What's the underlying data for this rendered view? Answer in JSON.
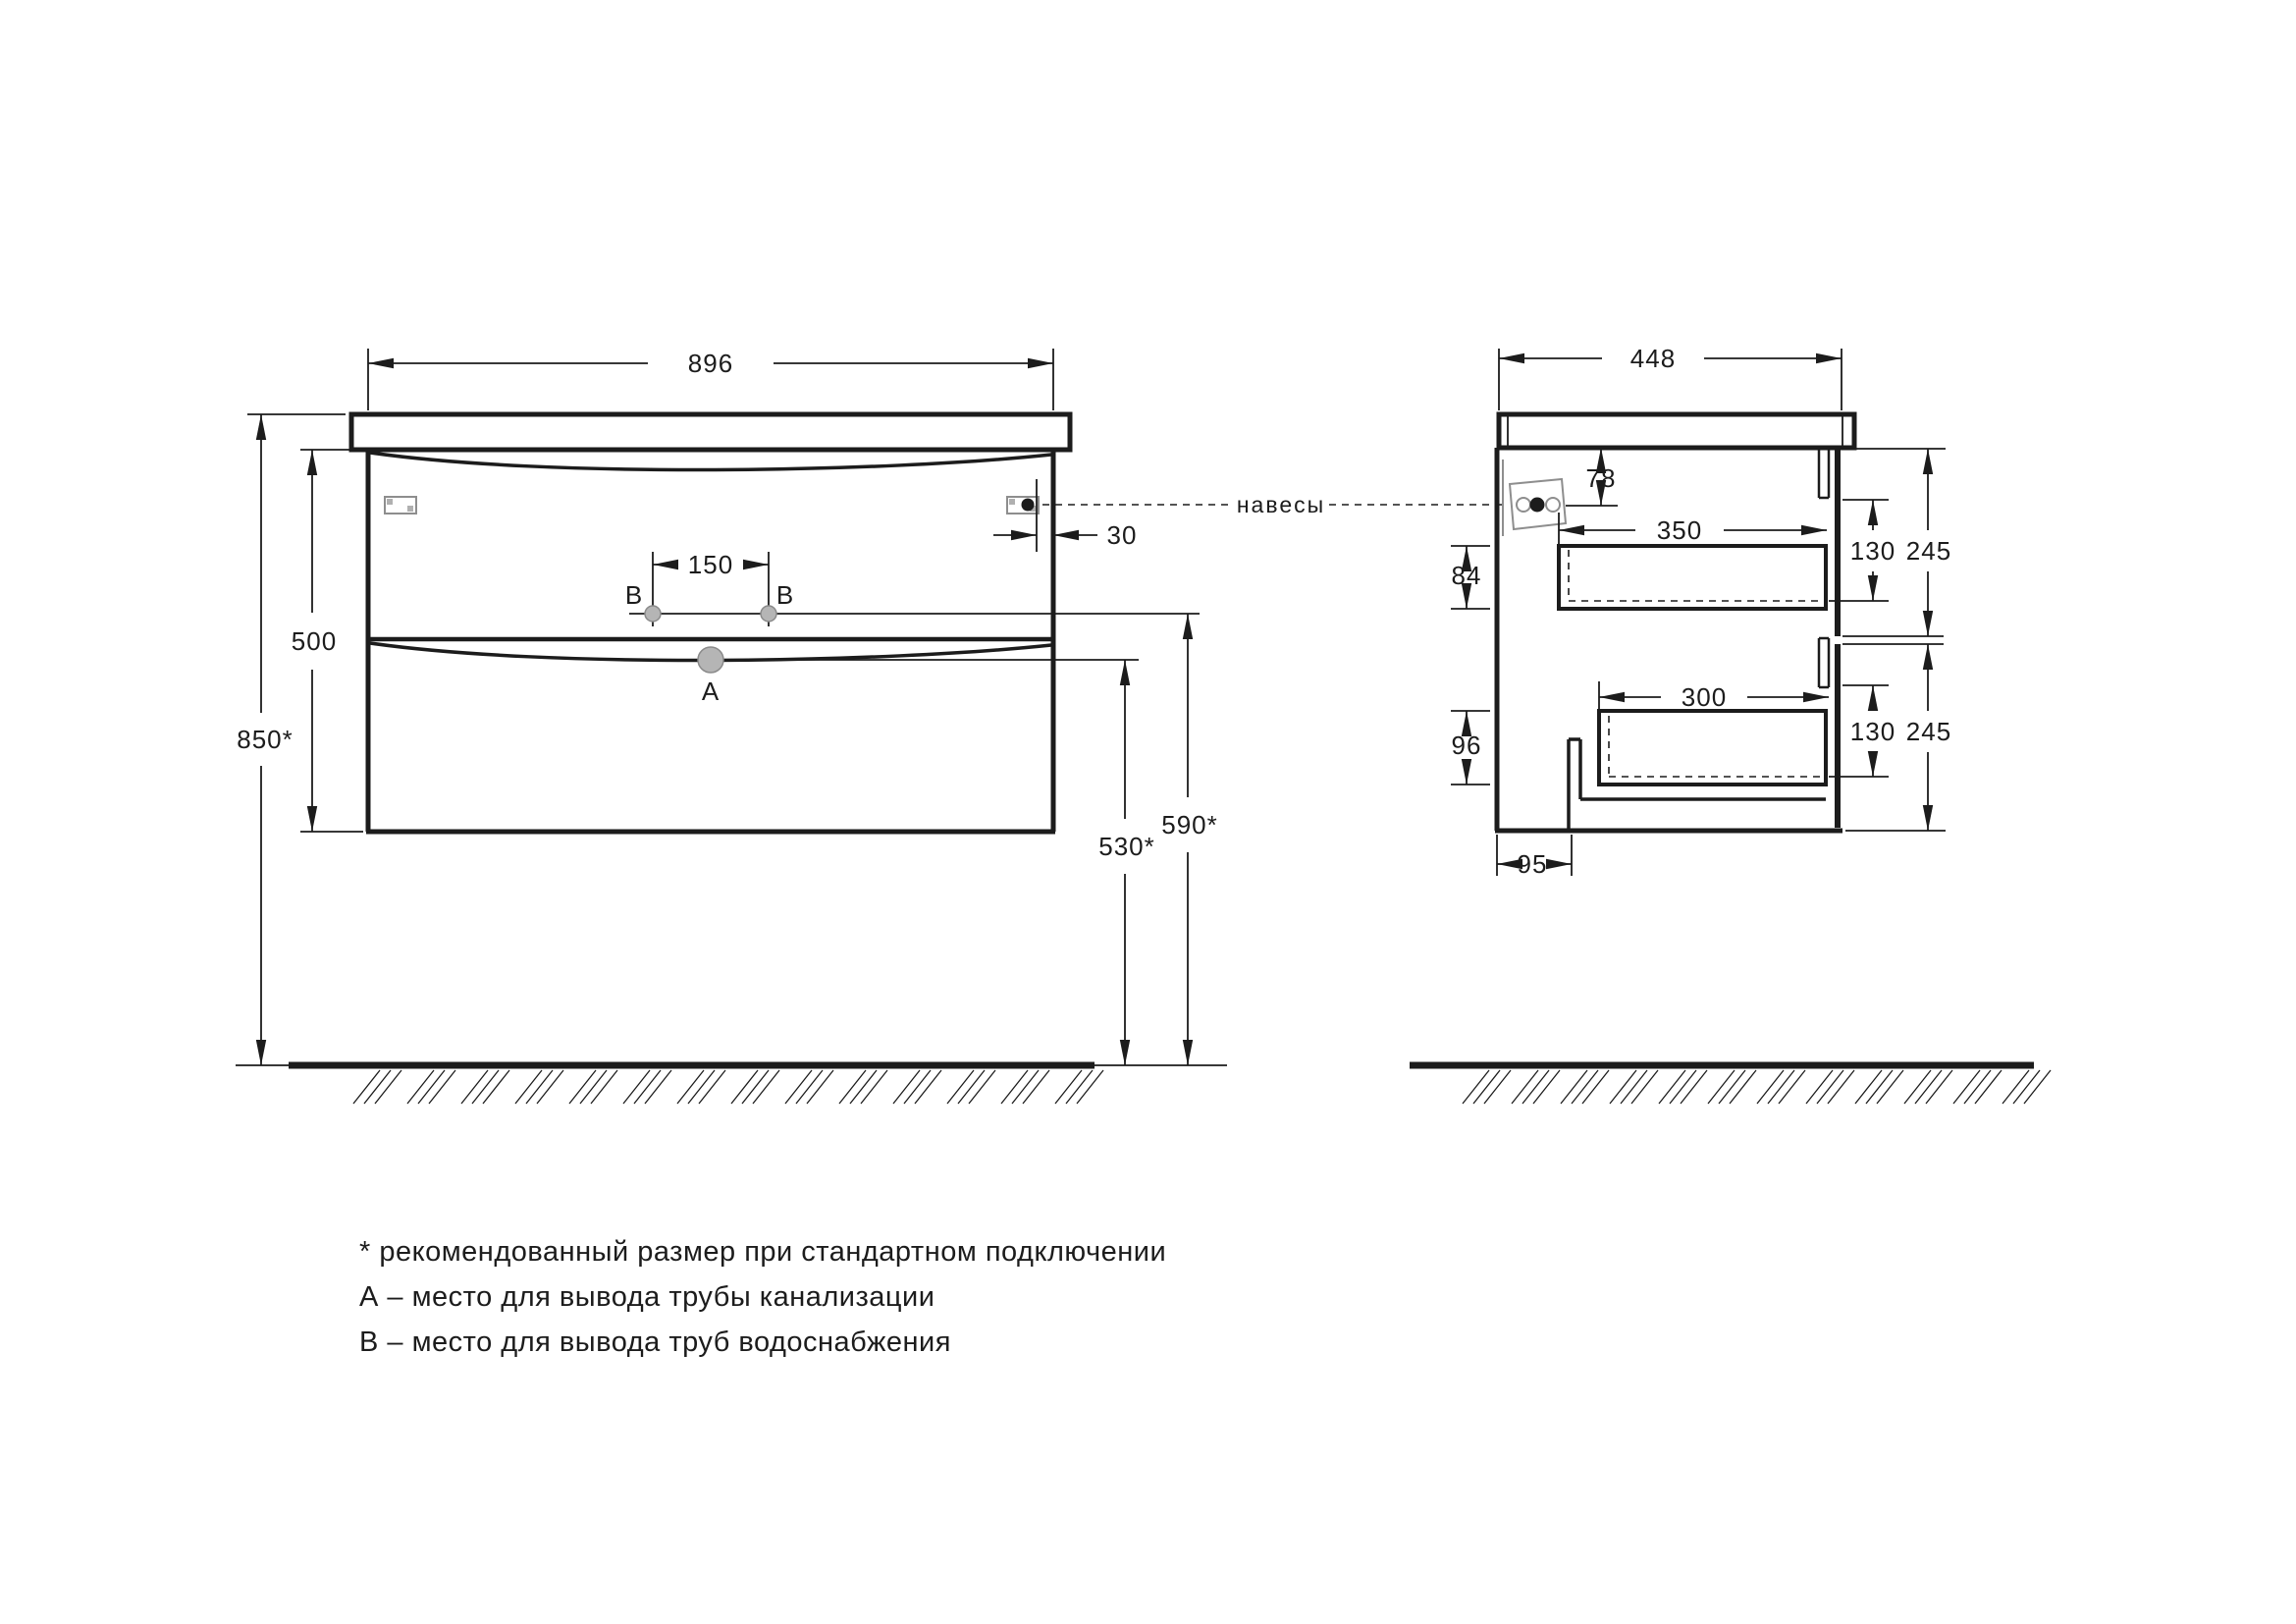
{
  "drawing": {
    "callout_hangers": "навесы",
    "label_drain": "А",
    "label_water": "В",
    "front_view": {
      "width": "896",
      "carcass_height": "500",
      "mount_height": "850*",
      "faucet_holes_spacing": "150",
      "hanger_edge_offset": "30",
      "drain_outlet_height": "530*",
      "water_outlet_height": "590*"
    },
    "side_view": {
      "depth": "448",
      "hanger_top_offset": "78",
      "top_drawer_depth": "350",
      "top_drawer_inner_height": "84",
      "top_drawer_clear_height": "130",
      "top_front_height": "245",
      "bottom_drawer_depth": "300",
      "bottom_drawer_inner_height": "96",
      "bottom_drawer_clear_height": "130",
      "bottom_front_height": "245",
      "back_recess_depth": "95"
    },
    "notes": [
      "* рекомендованный размер при стандартном подключении",
      "А – место для вывода трубы канализации",
      "В – место для вывода труб водоснабжения"
    ]
  }
}
